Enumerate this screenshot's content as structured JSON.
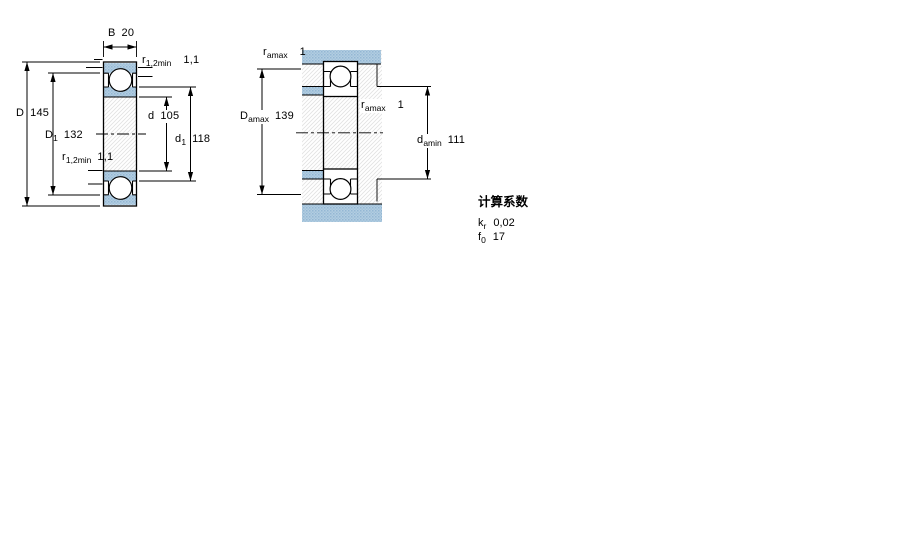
{
  "figure": {
    "left_view": {
      "description": "bearing cross-section with boundary dimensions",
      "dims": {
        "B": {
          "symbol": "B",
          "value": "20"
        },
        "D": {
          "symbol": "D",
          "value": "145"
        },
        "D1": {
          "symbol": "D",
          "sub": "1",
          "value": "132"
        },
        "r12_top": {
          "symbol": "r",
          "sub": "1,2min",
          "value": "1,1"
        },
        "r12_bottom": {
          "symbol": "r",
          "sub": "1,2min",
          "value": "1,1"
        },
        "d": {
          "symbol": "d",
          "value": "105"
        },
        "d1": {
          "symbol": "d",
          "sub": "1",
          "value": "118"
        }
      }
    },
    "right_view": {
      "description": "bearing mounted between shaft and housing abutments",
      "dims": {
        "ra_top": {
          "symbol": "r",
          "sub": "amax",
          "value": "1"
        },
        "Da_max": {
          "symbol": "D",
          "sub": "amax",
          "value": "139"
        },
        "ra_mid": {
          "symbol": "r",
          "sub": "amax",
          "value": "1"
        },
        "da_min": {
          "symbol": "d",
          "sub": "amin",
          "value": "111"
        }
      }
    }
  },
  "calculation_factors": {
    "heading": "计算系数",
    "rows": [
      {
        "symbol": "k",
        "sub": "r",
        "value": "0,02"
      },
      {
        "symbol": "f",
        "sub": "0",
        "value": "17"
      }
    ]
  },
  "colors": {
    "section_fill": "#b3cde1",
    "section_dot_a": "#93b7d4",
    "section_dot_b": "#a2c2da",
    "hatch_line": "#e2e2e2",
    "line": "#000000"
  }
}
